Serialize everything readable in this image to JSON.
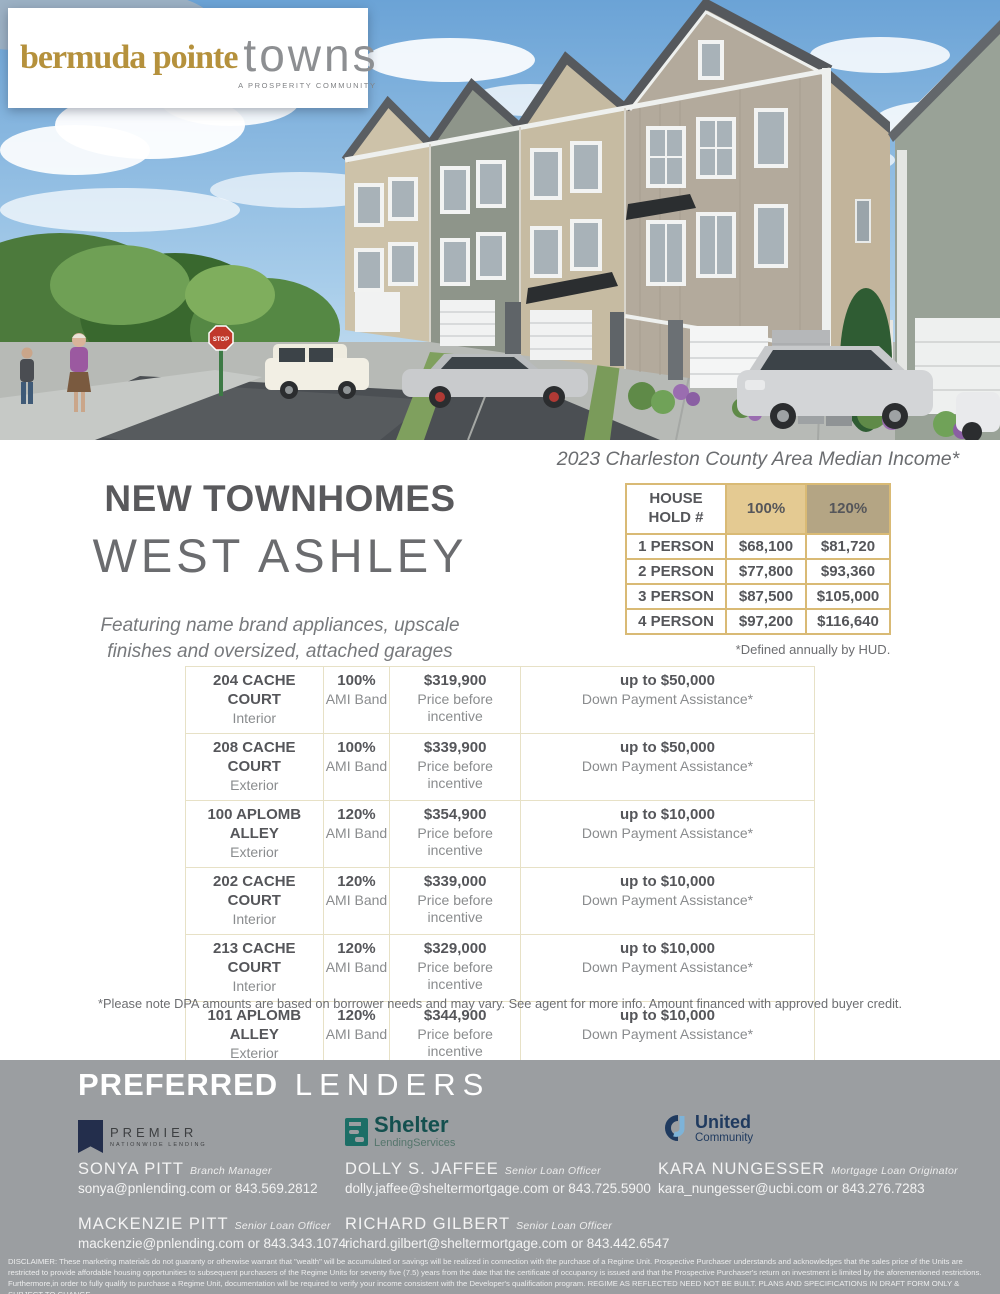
{
  "colors": {
    "brand_gold": "#b5913c",
    "table_border_gold": "#d9ba75",
    "ami_100_bg": "#e4ca92",
    "ami_120_bg": "#b4a584",
    "footer_bg": "#9b9ea1",
    "heading_gray": "#59595c"
  },
  "brand": {
    "name_gold": "bermuda pointe",
    "name_light": "towns",
    "tagline": "A PROSPERITY COMMUNITY"
  },
  "hero": {
    "stop_sign": "STOP"
  },
  "intro": {
    "title": "NEW TOWNHOMES",
    "subtitle": "WEST ASHLEY",
    "tagline": "Featuring name brand appliances, upscale finishes and oversized, attached garages"
  },
  "income": {
    "title": "2023 Charleston County Area Median Income*",
    "headers": [
      "HOUSE HOLD #",
      "100%",
      "120%"
    ],
    "rows": [
      [
        "1 PERSON",
        "$68,100",
        "$81,720"
      ],
      [
        "2 PERSON",
        "$77,800",
        "$93,360"
      ],
      [
        "3 PERSON",
        "$87,500",
        "$105,000"
      ],
      [
        "4 PERSON",
        "$97,200",
        "$116,640"
      ]
    ],
    "footnote": "*Defined annually by HUD."
  },
  "listings": {
    "rows": [
      {
        "address": "204 CACHE COURT",
        "unit_type": "Interior",
        "ami": "100%",
        "ami_label": "AMI Band",
        "price": "$319,900",
        "price_label": "Price before incentive",
        "dpa": "up to $50,000",
        "dpa_label": "Down Payment Assistance*"
      },
      {
        "address": "208 CACHE COURT",
        "unit_type": "Exterior",
        "ami": "100%",
        "ami_label": "AMI Band",
        "price": "$339,900",
        "price_label": "Price before incentive",
        "dpa": "up to $50,000",
        "dpa_label": "Down Payment Assistance*"
      },
      {
        "address": "100 APLOMB ALLEY",
        "unit_type": "Exterior",
        "ami": "120%",
        "ami_label": "AMI Band",
        "price": "$354,900",
        "price_label": "Price before incentive",
        "dpa": "up to $10,000",
        "dpa_label": "Down Payment Assistance*"
      },
      {
        "address": "202 CACHE COURT",
        "unit_type": "Interior",
        "ami": "120%",
        "ami_label": "AMI Band",
        "price": "$339,000",
        "price_label": "Price before incentive",
        "dpa": "up to $10,000",
        "dpa_label": "Down Payment Assistance*"
      },
      {
        "address": "213 CACHE COURT",
        "unit_type": "Interior",
        "ami": "120%",
        "ami_label": "AMI Band",
        "price": "$329,000",
        "price_label": "Price before incentive",
        "dpa": "up to $10,000",
        "dpa_label": "Down Payment Assistance*"
      },
      {
        "address": "101 APLOMB ALLEY",
        "unit_type": "Exterior",
        "ami": "120%",
        "ami_label": "AMI Band",
        "price": "$344,900",
        "price_label": "Price before incentive",
        "dpa": "up to $10,000",
        "dpa_label": "Down Payment Assistance*"
      },
      {
        "address": "105 APLOMB ALLEY",
        "unit_type": "Interior",
        "ami": "100%",
        "ami_label": "AMI Band",
        "price": "$349,900",
        "price_label": "Price before incentive",
        "dpa": "up to $50,000",
        "dpa_label": "Down Payment Assistance*"
      }
    ],
    "footnote": "*Please note DPA amounts are based on borrower needs and may vary.  See agent for more info.  Amount financed with approved buyer credit."
  },
  "lenders": {
    "heading_bold": "PREFERRED",
    "heading_light": "LENDERS",
    "premier": {
      "line1": "PREMIER",
      "line2": "NATIONWIDE LENDING"
    },
    "shelter": {
      "line1": "Shelter",
      "line2": "LendingServices"
    },
    "united": {
      "line1": "United",
      "line2": "Community"
    },
    "contacts": [
      {
        "name": "SONYA PITT",
        "title": "Branch Manager",
        "contact": "sonya@pnlending.com or 843.569.2812"
      },
      {
        "name": "DOLLY S. JAFFEE",
        "title": "Senior Loan Officer",
        "contact": "dolly.jaffee@sheltermortgage.com or 843.725.5900"
      },
      {
        "name": "KARA NUNGESSER",
        "title": "Mortgage Loan Originator",
        "contact": "kara_nungesser@ucbi.com or 843.276.7283"
      },
      {
        "name": "MACKENZIE PITT",
        "title": "Senior Loan Officer",
        "contact": "mackenzie@pnlending.com or 843.343.1074"
      },
      {
        "name": "RICHARD GILBERT",
        "title": "Senior Loan Officer",
        "contact": "richard.gilbert@sheltermortgage.com or 843.442.6547"
      }
    ],
    "disclaimer": "DISCLAIMER: These marketing materials do not guaranty or otherwise warrant that \"wealth\" will be accumulated or savings will be realized in connection with the purchase of a Regime Unit. Prospective Purchaser understands and acknowledges that the sales price of the Units are restricted to provide affordable housing opportunities to subsequent purchasers of the Regime Units for seventy five (7.5) years from the date that the certificate of occupancy is issued and that the Prospective Purchaser's return on investment is limited by the aforementioned restrictions. Furthermore,in order to fully qualify to purchase a Regime Unit, documentation will be required to verify your income consistent with the Developer's qualification program. REGIME AS REFLECTED NEED NOT BE BUILT. PLANS AND SPECIFICATIONS IN DRAFT FORM ONLY & SUBJECT TO CHANGE."
  }
}
